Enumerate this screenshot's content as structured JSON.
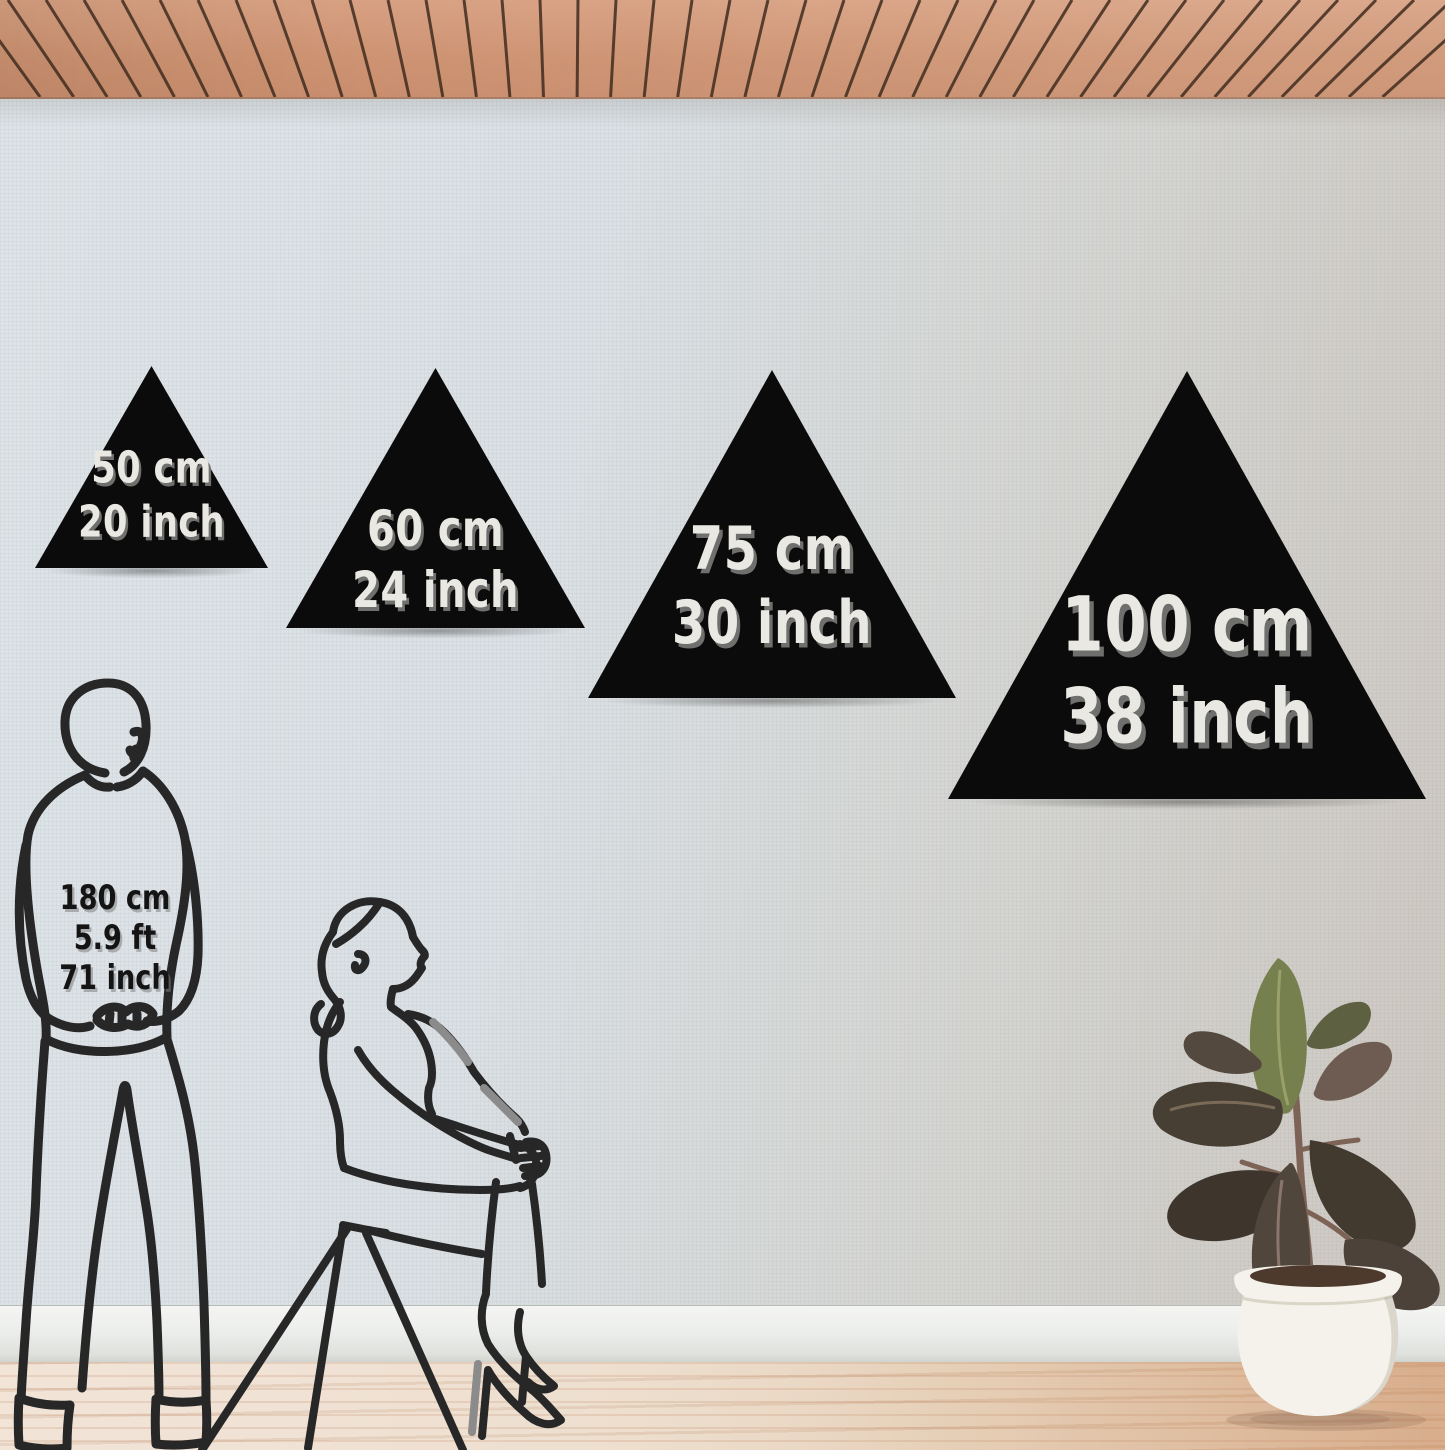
{
  "scene": {
    "description": "Wall decor size comparison scene",
    "wall_color": "#d8dde1",
    "ceiling_wood_color": "#cf9776",
    "floor_color": "#e9d8c7",
    "triangle_color": "#0b0b0b",
    "label_text_color": "#e9e8e3"
  },
  "sizes": [
    {
      "cm": "50 cm",
      "inch": "20 inch"
    },
    {
      "cm": "60 cm",
      "inch": "24 inch"
    },
    {
      "cm": "75 cm",
      "inch": "30 inch"
    },
    {
      "cm": "100 cm",
      "inch": "38 inch"
    }
  ],
  "person_reference": {
    "height_cm": "180 cm",
    "height_ft": "5.9 ft",
    "height_in": "71 inch"
  }
}
